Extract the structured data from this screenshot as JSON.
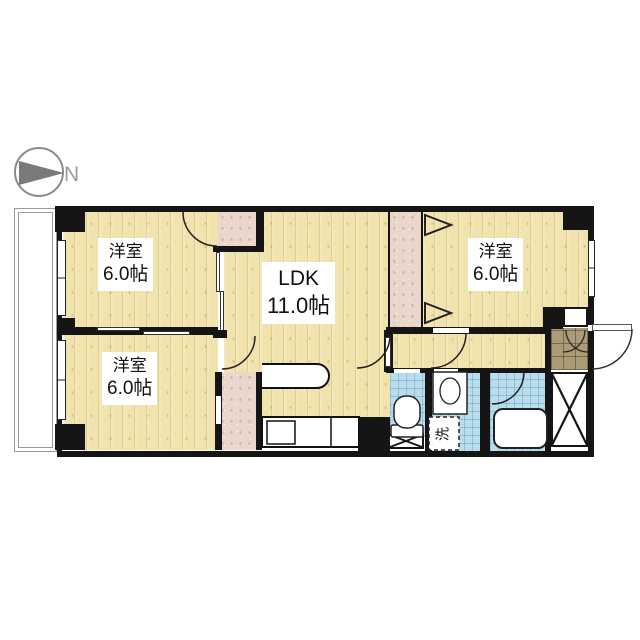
{
  "compass": {
    "label": "N"
  },
  "rooms": {
    "room_top_left": {
      "name": "洋室",
      "size": "6.0帖"
    },
    "room_bottom_left": {
      "name": "洋室",
      "size": "6.0帖"
    },
    "ldk": {
      "name": "LDK",
      "size": "11.0帖"
    },
    "room_top_right": {
      "name": "洋室",
      "size": "6.0帖"
    }
  },
  "fixtures": {
    "washer_label": "洗"
  },
  "colors": {
    "wall": "#151515",
    "wood": "#f1e3ad",
    "closet": "#ead6ca",
    "tile": "#badded",
    "genkan": "#a99c76"
  }
}
